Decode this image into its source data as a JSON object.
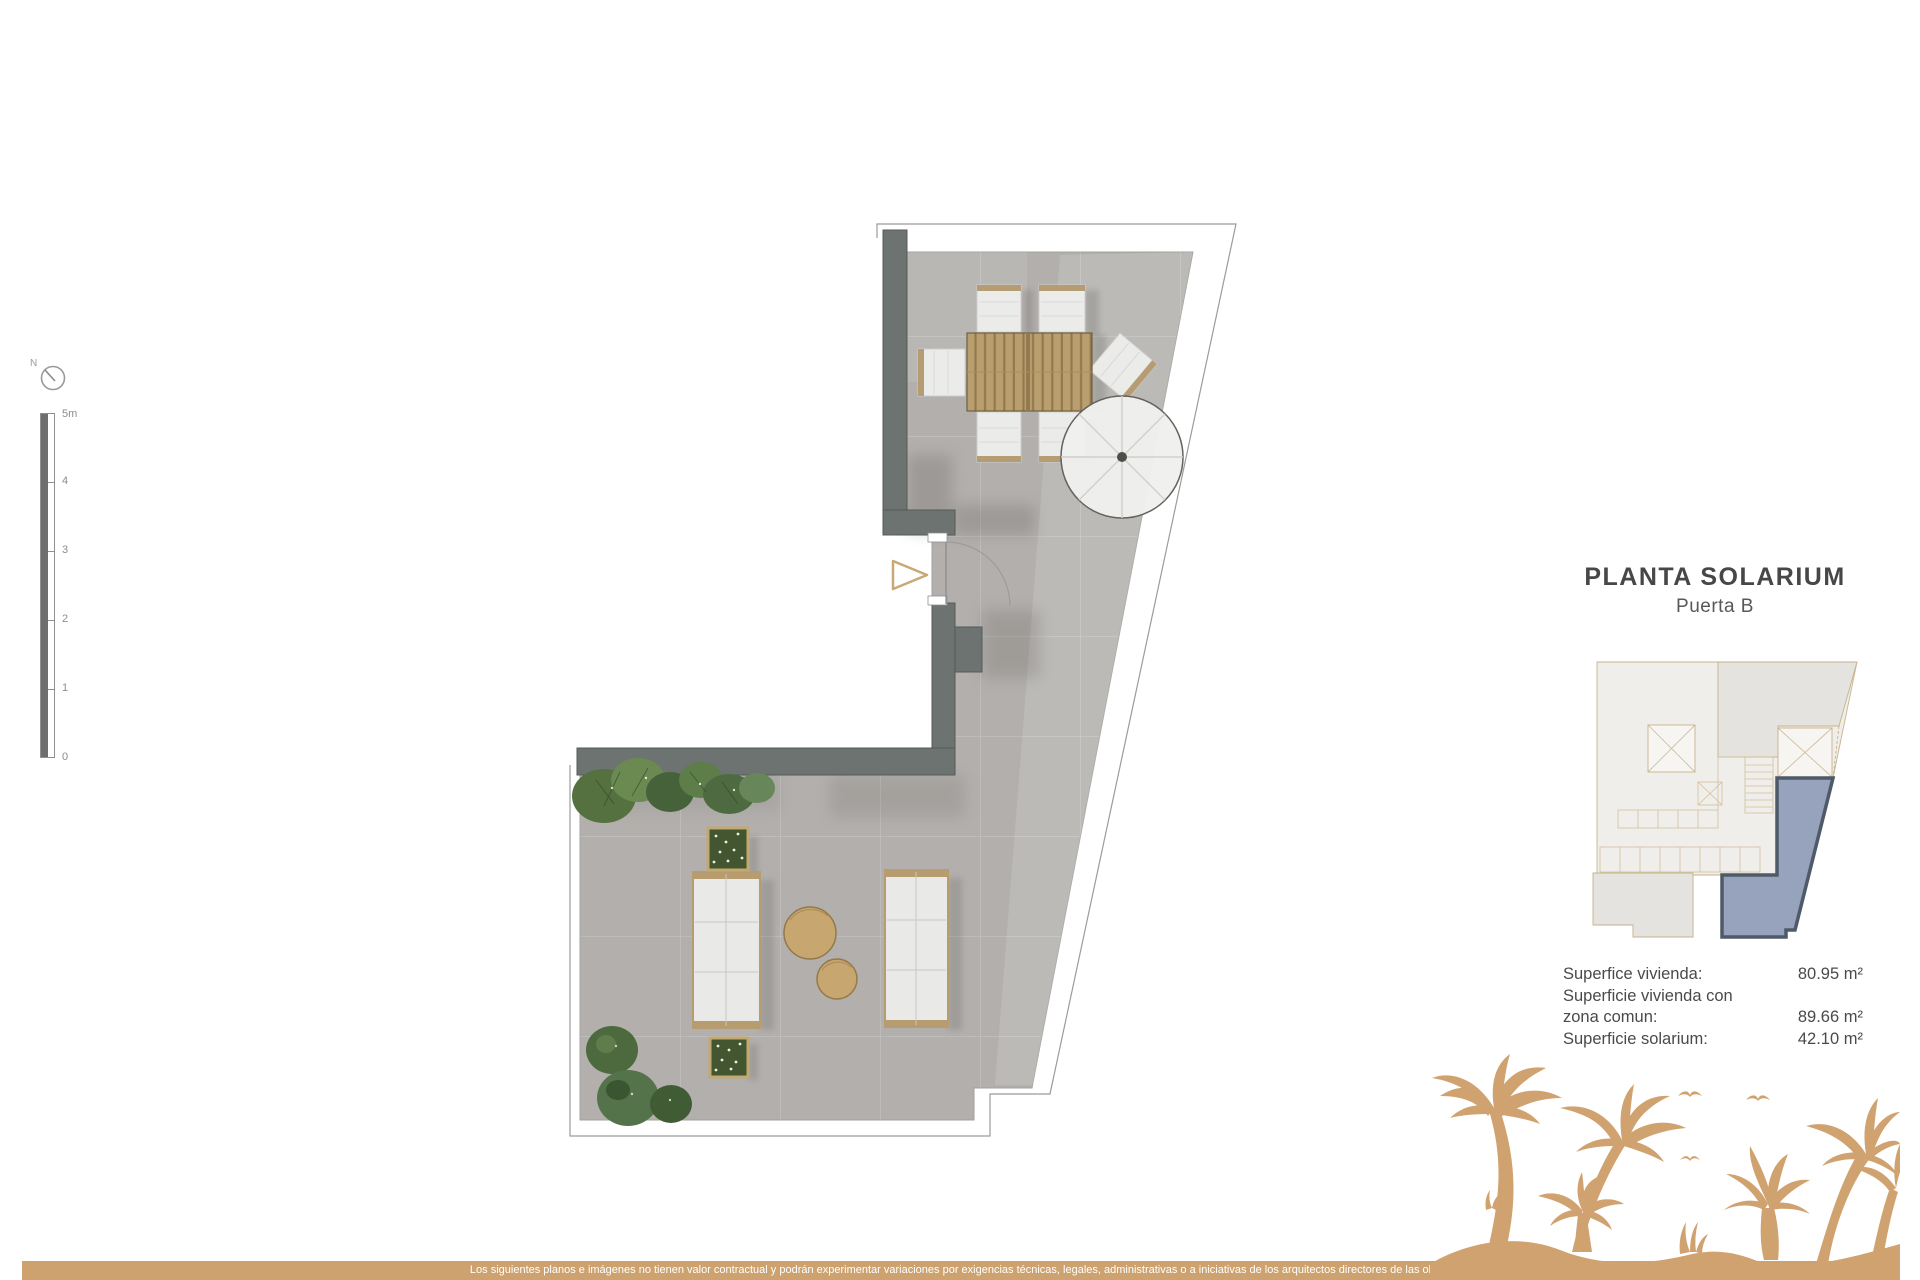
{
  "header": {
    "title": "PLANTA SOLARIUM",
    "subtitle": "Puerta B"
  },
  "compass": {
    "label": "N"
  },
  "scale_bar": {
    "labels": [
      "5m",
      "4",
      "3",
      "2",
      "1",
      "0"
    ]
  },
  "areas": {
    "rows": [
      {
        "label": "Superfice vivienda:",
        "value": "80.95 m²"
      },
      {
        "label": "Superficie vivienda con",
        "value": ""
      },
      {
        "label": "zona comun:",
        "value": "89.66 m²"
      },
      {
        "label": "Superficie solarium:",
        "value": "42.10 m²"
      }
    ]
  },
  "footer": {
    "disclaimer": "Los siguientes planos e imágenes no tienen valor contractual y podrán experimentar variaciones por exigencias técnicas, legales, administrativas o a iniciativas de los arquitectos directores de las obras"
  },
  "colors": {
    "accent_tan": "#d0a26f",
    "wall_gray": "#6d7370",
    "tile_gray": "#b2afac",
    "unit_blue": "#97a3bc",
    "unit_blue_border": "#4f5a68",
    "text_dark": "#4a4a4c"
  }
}
